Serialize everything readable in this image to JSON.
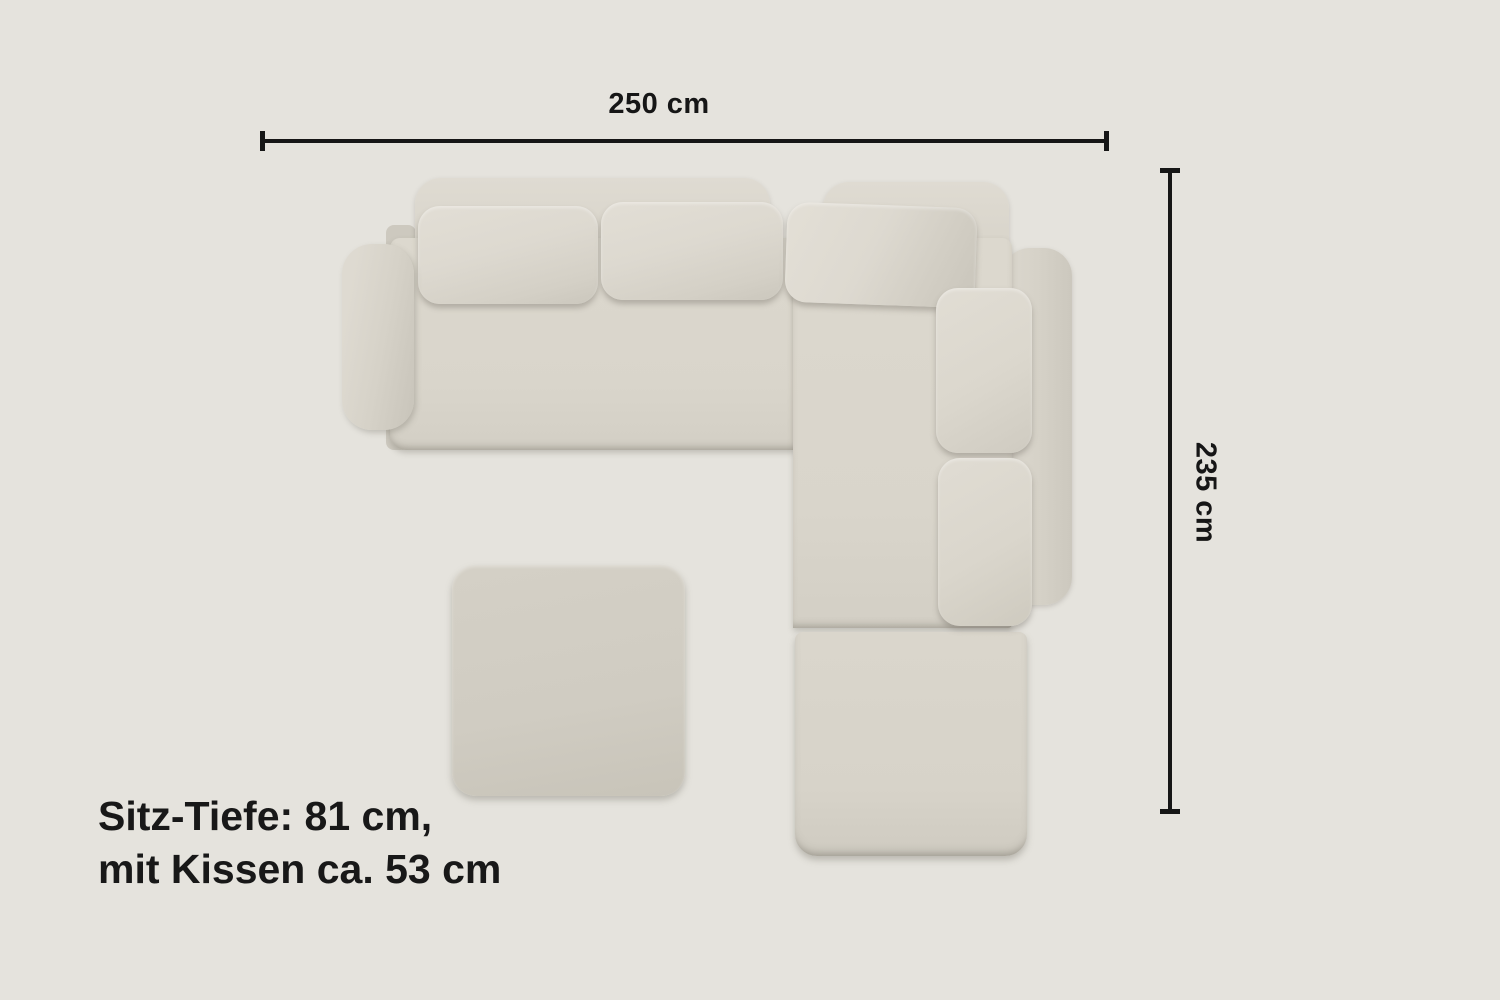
{
  "dimension_width": {
    "label": "250 cm"
  },
  "dimension_height": {
    "label": "235 cm"
  },
  "caption": {
    "line1": "Sitz-Tiefe: 81 cm,",
    "line2": "mit Kissen ca. 53 cm"
  },
  "colors": {
    "background": "#e5e3dd",
    "annotation": "#161616",
    "sofa_body": "#d9d5cb",
    "sofa_cushion": "#ddd9d0",
    "sofa_rail": "#d8d4ca",
    "ottoman": "#d0ccc2"
  },
  "sofa": {
    "parts": [
      "left-backrest-rail",
      "corner-backrest-rail",
      "right-backrest-rail",
      "left-seat",
      "corner-seat",
      "end-seat-module",
      "back-cushion-1",
      "back-cushion-2",
      "corner-back-cushion",
      "right-back-cushion-1",
      "right-back-cushion-2",
      "left-armrest",
      "ottoman"
    ]
  }
}
